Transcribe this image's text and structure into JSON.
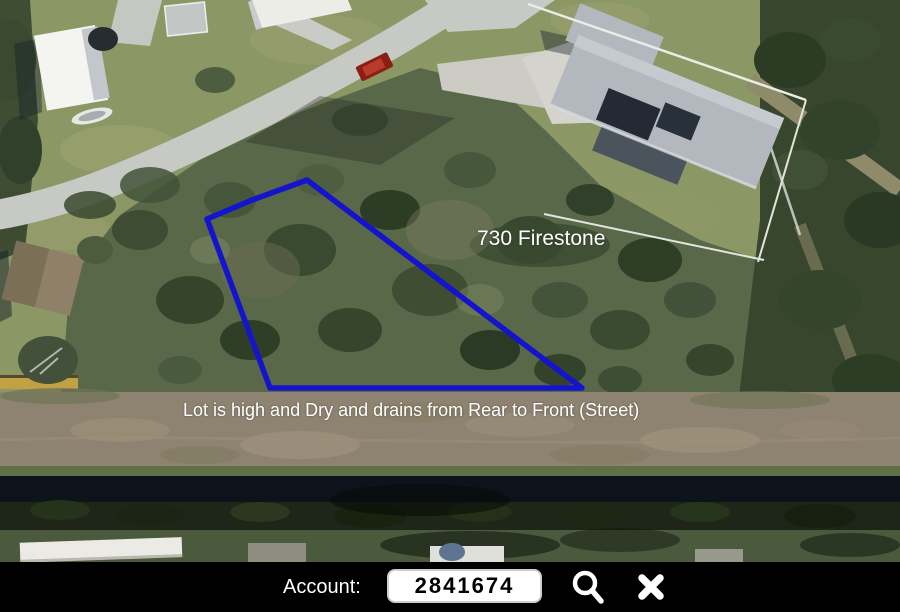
{
  "map": {
    "type": "aerial-photo",
    "address_label": "730 Firestone",
    "lot_note": "Lot is high and Dry and drains from Rear to Front (Street)",
    "lot_outline_color": "#1414cc",
    "annotation_text_color": "#ffffff"
  },
  "toolbar": {
    "account_label": "Account:",
    "account_field": {
      "value": "2841674"
    },
    "search_icon": "magnifier",
    "close_icon": "x-cross",
    "background_color": "#000000",
    "icon_color": "#ffffff"
  }
}
